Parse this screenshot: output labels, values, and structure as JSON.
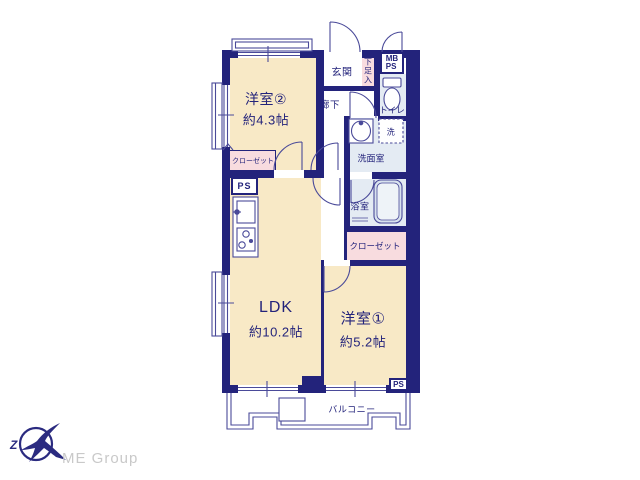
{
  "plan": {
    "rooms": {
      "room2": {
        "name": "洋室②",
        "size": "約4.3帖"
      },
      "ldk": {
        "name": "LDK",
        "size": "約10.2帖"
      },
      "room1": {
        "name": "洋室①",
        "size": "約5.2帖"
      }
    },
    "labels": {
      "genkan": "玄関",
      "shoebox": "下足入",
      "hallway": "廊下",
      "toilet": "トイレ",
      "washroom": "洗面室",
      "washer": "洗",
      "bathroom": "浴室",
      "closet_left": "クローゼット",
      "closet_right": "クローゼット",
      "mb": "MB",
      "ps": "PS",
      "ps_left": "PS",
      "ps_right": "PS",
      "balcony": "バルコニー"
    },
    "colors": {
      "wall_navy": "#23237B",
      "room_cream": "#F8E9C6",
      "closet_pink": "#F8DCDF",
      "wet_blue": "#E4EBF3",
      "thin_line": "#4A4A99",
      "logo_navy": "#2B2B80",
      "footer_gray": "#C9C9C9"
    }
  },
  "footer": {
    "brand": "ME Group"
  }
}
